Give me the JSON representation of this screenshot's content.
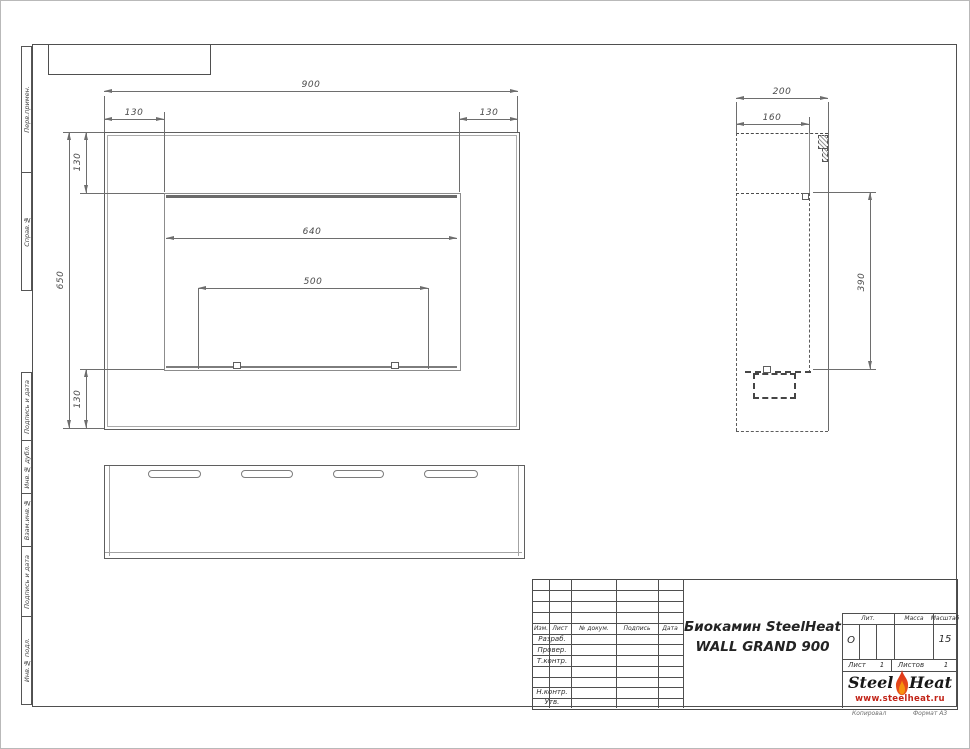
{
  "drawing": {
    "product_title_line1": "Биокамин SteelHeat",
    "product_title_line2": "WALL GRAND 900"
  },
  "margin_labels": [
    "Перв.примен.",
    "Справ.№",
    "Подпись и дата",
    "Инв.№ дубл.",
    "Взам.инв.№",
    "Подпись и дата",
    "Инв.№ подл."
  ],
  "front_view": {
    "dim_overall_width": "900",
    "dim_inset_left": "130",
    "dim_inset_right": "130",
    "dim_overall_height": "650",
    "dim_inset_top": "130",
    "dim_inset_bottom": "130",
    "dim_opening_width": "640",
    "dim_burner_width": "500"
  },
  "side_view": {
    "dim_depth": "200",
    "dim_body_depth": "160",
    "dim_opening_height": "390"
  },
  "title_block": {
    "header_cols": [
      "Изм.",
      "Лист",
      "№ докум.",
      "Подпись",
      "Дата"
    ],
    "row_labels": [
      "Разраб.",
      "Провер.",
      "Т.контр.",
      "Н.контр.",
      "Утв."
    ],
    "lit_label": "Лит.",
    "lit_value": "О",
    "mass_label": "Масса",
    "scale_label": "Масштаб",
    "scale_value": "15",
    "sheet_label": "Лист",
    "sheet_value": "1",
    "sheets_label": "Листов",
    "sheets_value": "1",
    "logo_steel": "Steel",
    "logo_heat": "Heat",
    "logo_url": "www.steelheat.ru",
    "footer_copy": "Копировал",
    "footer_format": "Формат А3"
  }
}
